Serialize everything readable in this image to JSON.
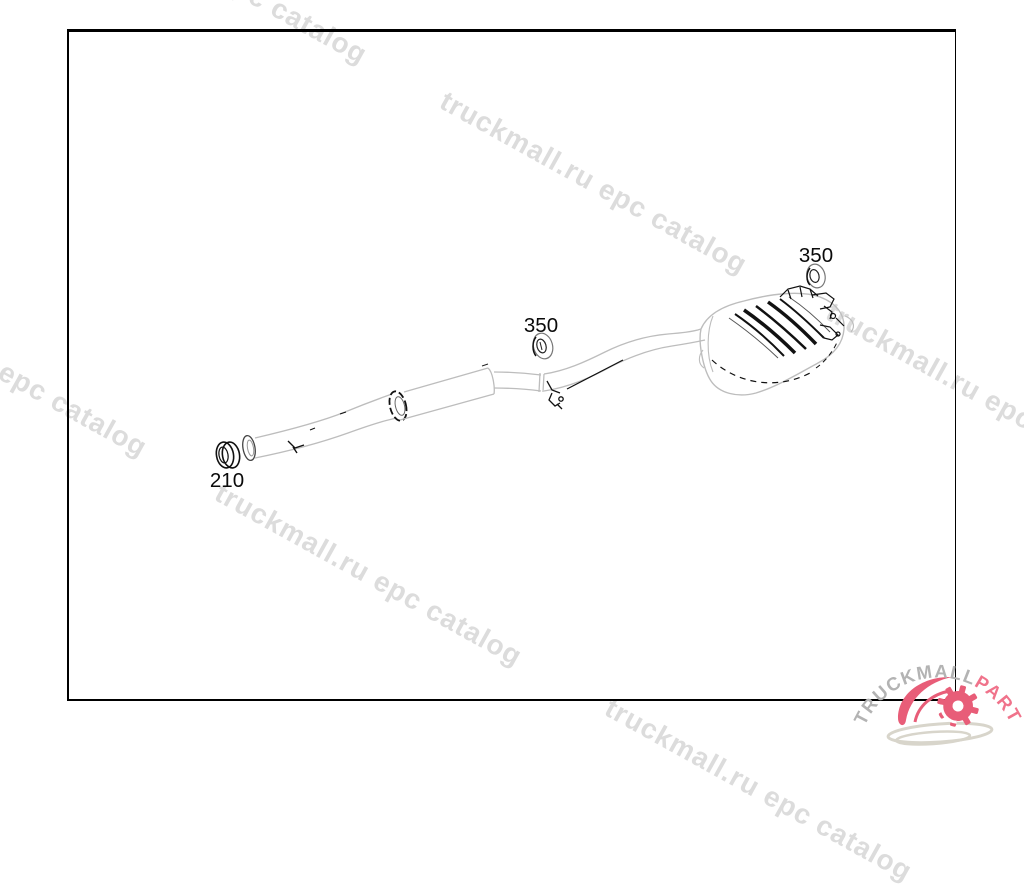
{
  "window": {
    "background": "#ffffff"
  },
  "watermark": {
    "text": "truckmall.ru epc catalog",
    "color": "#dcdcdc"
  },
  "diagram": {
    "line_color": "#bdbdbd",
    "detail_color": "#111111",
    "part_labels": [
      {
        "id": "210",
        "text": "210"
      },
      {
        "id": "350-mid",
        "text": "350"
      },
      {
        "id": "350-right",
        "text": "350"
      }
    ]
  },
  "logo": {
    "text_primary": "TRUCKMALL",
    "text_secondary": "PARTS",
    "primary_color": "#b3b3b3",
    "secondary_color": "#f0738b",
    "gear_color": "#e85d78",
    "swoosh_color": "#d8d5cb"
  }
}
